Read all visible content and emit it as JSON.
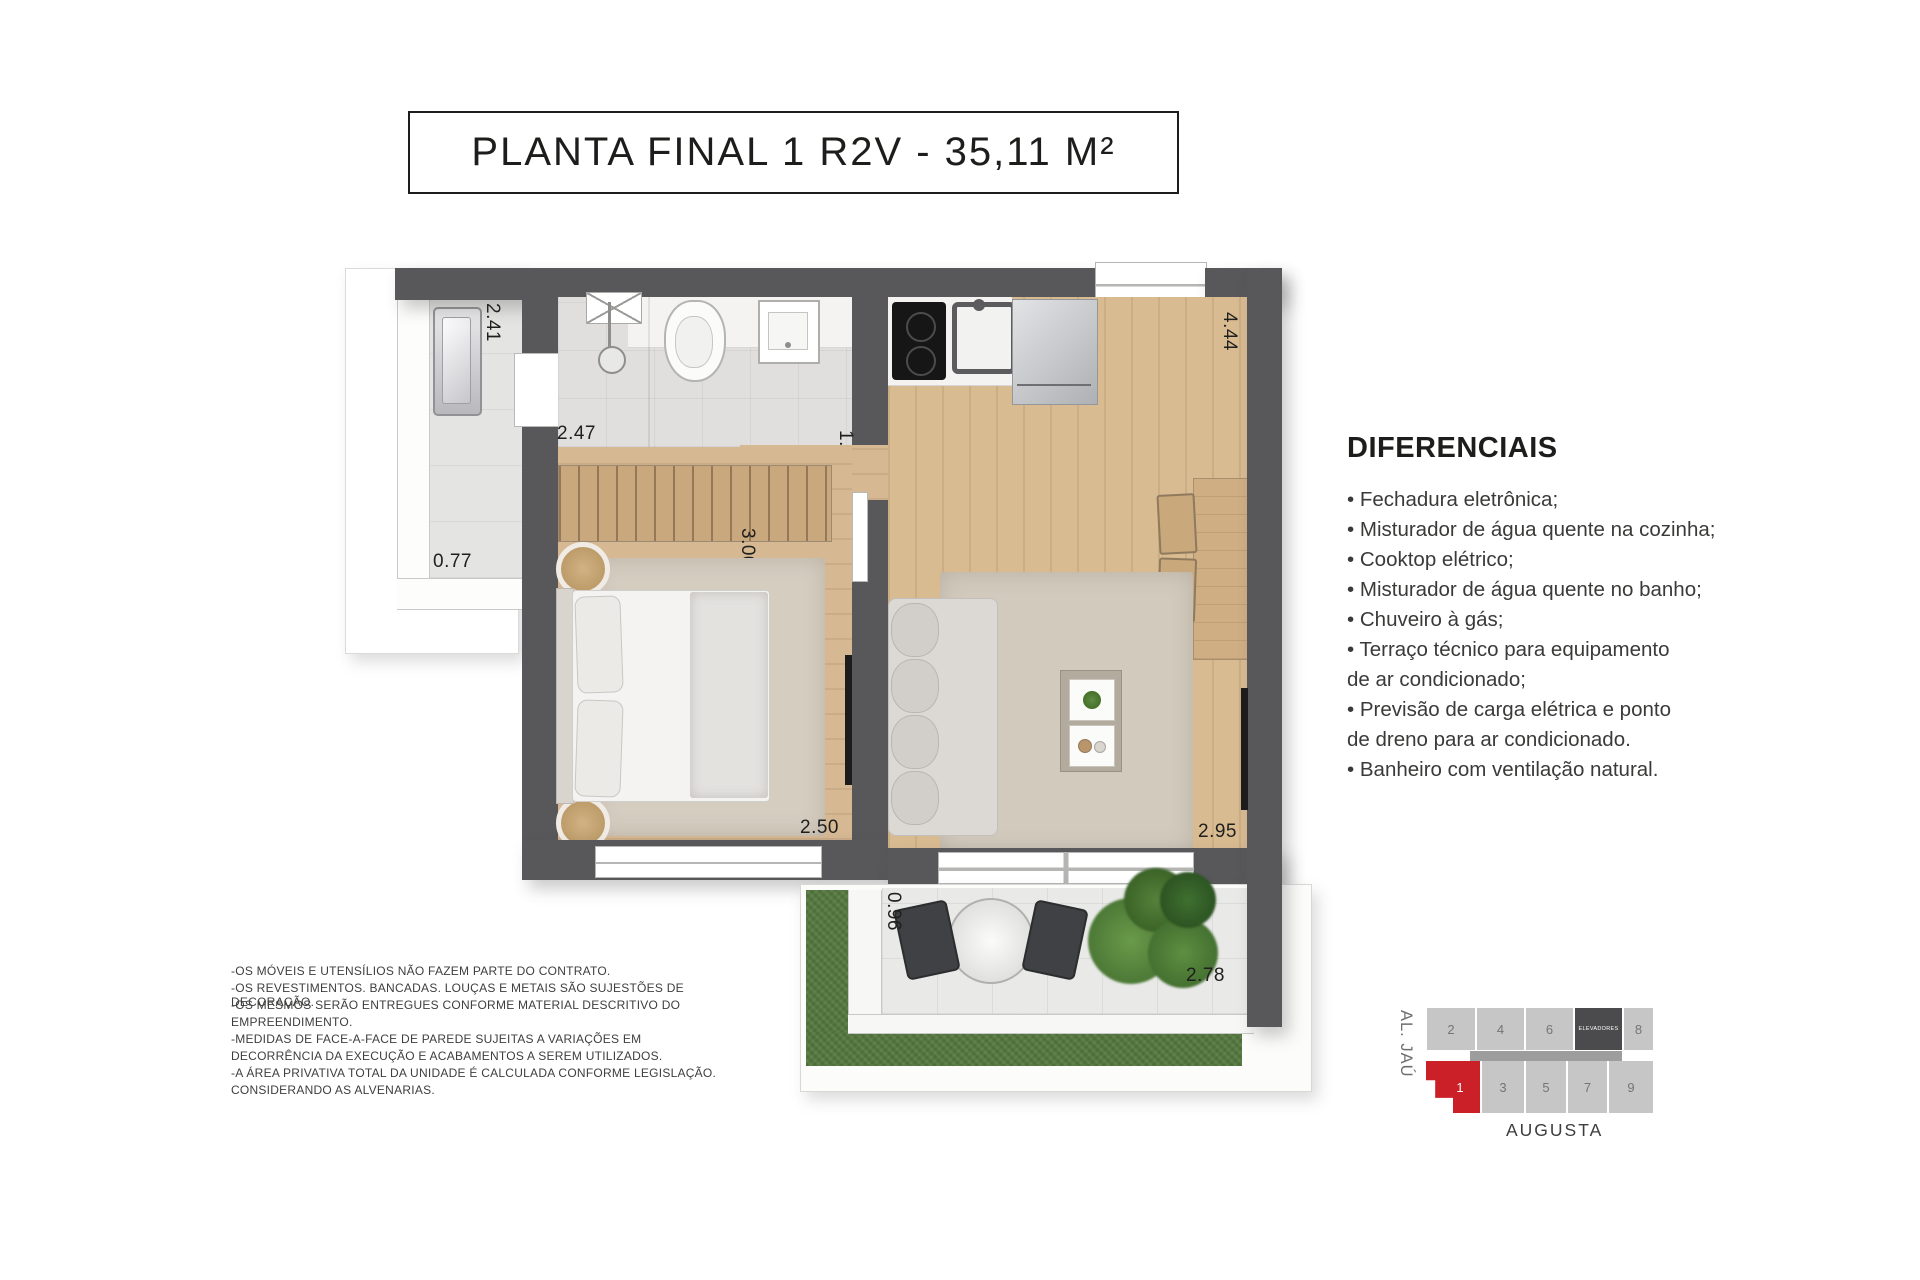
{
  "title": {
    "text": "PLANTA FINAL 1 R2V - 35,11 M²"
  },
  "plan": {
    "dims": {
      "terrace_length": "2.41",
      "terrace_width": "0.77",
      "bath_width": "2.47",
      "hall_width": "1.30",
      "wardrobe_depth": "3.00",
      "kitchen_length": "4.44",
      "bedroom_width": "2.50",
      "living_width": "2.95",
      "balcony_depth": "0.96",
      "balcony_width": "2.78"
    }
  },
  "diferenciais": {
    "heading": "DIFERENCIAIS",
    "lines": [
      "• Fechadura eletrônica;",
      "• Misturador de água quente na cozinha;",
      "• Cooktop elétrico;",
      "• Misturador de água quente no banho;",
      "• Chuveiro à gás;",
      "• Terraço técnico para equipamento",
      "de ar condicionado;",
      "• Previsão de carga elétrica e ponto",
      "de dreno para ar condicionado.",
      "• Banheiro com ventilação natural."
    ]
  },
  "disclaimer": {
    "lines": [
      "-OS MÓVEIS E UTENSÍLIOS NÃO FAZEM PARTE DO CONTRATO.",
      "-OS REVESTIMENTOS. BANCADAS. LOUÇAS E METAIS SÃO SUJESTÕES DE DECORAÇÃO.",
      "-OS MESMOS SERÃO ENTREGUES CONFORME MATERIAL DESCRITIVO DO",
      "EMPREENDIMENTO.",
      "-MEDIDAS DE FACE-A-FACE DE PAREDE SUJEITAS A VARIAÇÕES EM",
      "DECORRÊNCIA DA EXECUÇÃO E ACABAMENTOS A SEREM UTILIZADOS.",
      "-A ÁREA PRIVATIVA TOTAL DA UNIDADE É CALCULADA CONFORME LEGISLAÇÃO.",
      "CONSIDERANDO AS ALVENARIAS."
    ]
  },
  "keyplan": {
    "street_left": "AL. JAÚ",
    "street_bottom": "AUGUSTA",
    "units_top": [
      "2",
      "4",
      "6"
    ],
    "elevators": "ELEVADORES",
    "unit_8": "8",
    "units_bottom": [
      "1",
      "3",
      "5",
      "7",
      "9"
    ]
  },
  "colors": {
    "highlight_red": "#cb2027",
    "wall_dark": "#58585a",
    "elevator_dark": "#4b4b4d"
  }
}
